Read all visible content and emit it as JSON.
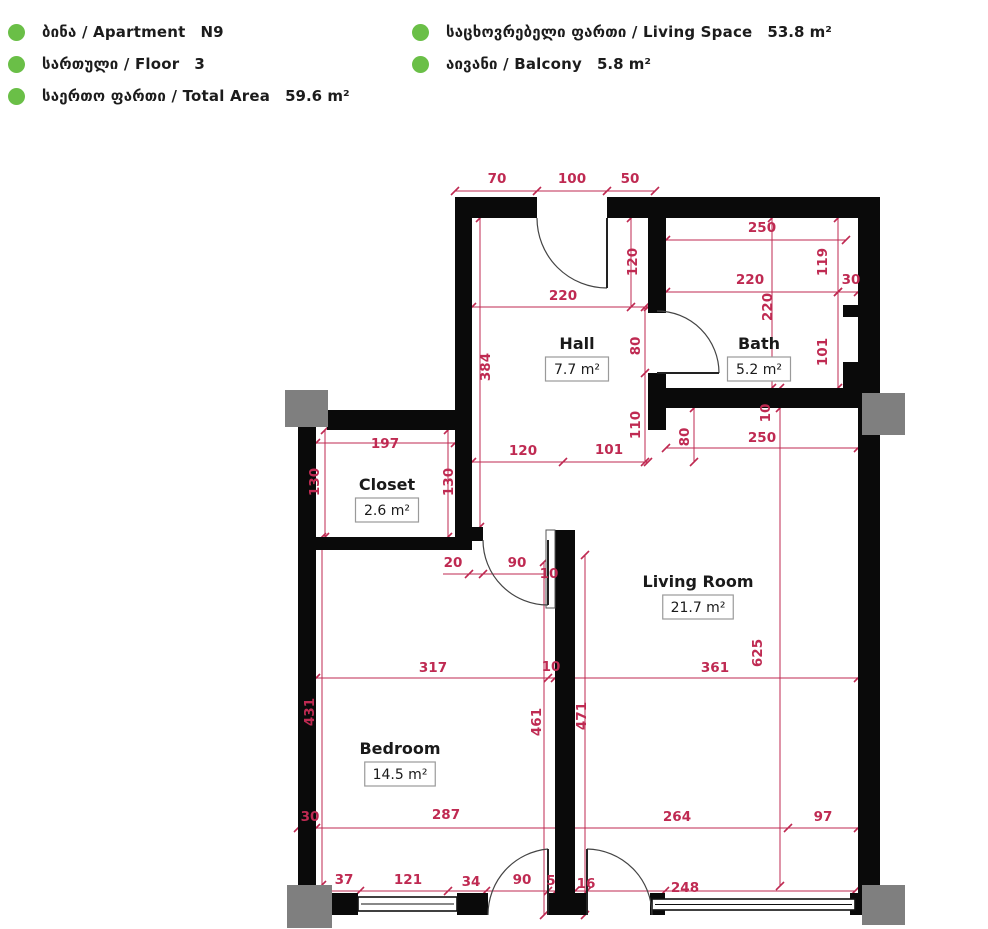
{
  "header": {
    "left": [
      {
        "label": "ბინა / Apartment",
        "value": "N9"
      },
      {
        "label": "სართული / Floor",
        "value": "3"
      },
      {
        "label": "საერთო ფართი / Total Area",
        "value": "59.6 m²"
      }
    ],
    "right": [
      {
        "label": "საცხოვრებელი ფართი / Living Space",
        "value": "53.8 m²"
      },
      {
        "label": "აივანი / Balcony",
        "value": "5.8 m²"
      }
    ]
  },
  "colors": {
    "accent_green": "#6abf47",
    "dim_red": "#bf2a52",
    "wall_black": "#0a0a0a",
    "column_gray": "#7f7f7f",
    "box_border": "#9a9a9a"
  },
  "plan": {
    "rooms": [
      {
        "name": "Hall",
        "area": "7.7 m²",
        "x": 577,
        "y": 349
      },
      {
        "name": "Bath",
        "area": "5.2 m²",
        "x": 759,
        "y": 349
      },
      {
        "name": "Closet",
        "area": "2.6 m²",
        "x": 387,
        "y": 490
      },
      {
        "name": "Living Room",
        "area": "21.7 m²",
        "x": 698,
        "y": 587
      },
      {
        "name": "Bedroom",
        "area": "14.5 m²",
        "x": 400,
        "y": 754
      }
    ],
    "dims": [
      {
        "v": "70",
        "x": 497,
        "y": 183,
        "r": 0
      },
      {
        "v": "100",
        "x": 572,
        "y": 183,
        "r": 0
      },
      {
        "v": "50",
        "x": 630,
        "y": 183,
        "r": 0
      },
      {
        "v": "250",
        "x": 762,
        "y": 232,
        "r": 0
      },
      {
        "v": "119",
        "x": 827,
        "y": 262,
        "r": 1
      },
      {
        "v": "220",
        "x": 750,
        "y": 284,
        "r": 0
      },
      {
        "v": "30",
        "x": 851,
        "y": 284,
        "r": 0
      },
      {
        "v": "220",
        "x": 772,
        "y": 307,
        "r": 1
      },
      {
        "v": "101",
        "x": 827,
        "y": 352,
        "r": 1
      },
      {
        "v": "120",
        "x": 637,
        "y": 262,
        "r": 1
      },
      {
        "v": "220",
        "x": 563,
        "y": 300,
        "r": 0
      },
      {
        "v": "384",
        "x": 490,
        "y": 367,
        "r": 1
      },
      {
        "v": "80",
        "x": 640,
        "y": 346,
        "r": 1
      },
      {
        "v": "110",
        "x": 640,
        "y": 425,
        "r": 1
      },
      {
        "v": "80",
        "x": 689,
        "y": 437,
        "r": 1
      },
      {
        "v": "250",
        "x": 762,
        "y": 442,
        "r": 0
      },
      {
        "v": "10",
        "x": 770,
        "y": 413,
        "r": 1
      },
      {
        "v": "197",
        "x": 385,
        "y": 448,
        "r": 0
      },
      {
        "v": "130",
        "x": 319,
        "y": 482,
        "r": 1
      },
      {
        "v": "130",
        "x": 453,
        "y": 482,
        "r": 1
      },
      {
        "v": "120",
        "x": 523,
        "y": 455,
        "r": 0
      },
      {
        "v": "101",
        "x": 609,
        "y": 454,
        "r": 0
      },
      {
        "v": "20",
        "x": 453,
        "y": 567,
        "r": 0
      },
      {
        "v": "90",
        "x": 517,
        "y": 567,
        "r": 0
      },
      {
        "v": "10",
        "x": 549,
        "y": 578,
        "r": 0
      },
      {
        "v": "317",
        "x": 433,
        "y": 672,
        "r": 0
      },
      {
        "v": "10",
        "x": 551,
        "y": 671,
        "r": 0
      },
      {
        "v": "361",
        "x": 715,
        "y": 672,
        "r": 0
      },
      {
        "v": "625",
        "x": 762,
        "y": 653,
        "r": 1
      },
      {
        "v": "431",
        "x": 314,
        "y": 712,
        "r": 1
      },
      {
        "v": "461",
        "x": 541,
        "y": 722,
        "r": 1
      },
      {
        "v": "471",
        "x": 586,
        "y": 716,
        "r": 1
      },
      {
        "v": "30",
        "x": 310,
        "y": 821,
        "r": 0
      },
      {
        "v": "287",
        "x": 446,
        "y": 819,
        "r": 0
      },
      {
        "v": "264",
        "x": 677,
        "y": 821,
        "r": 0
      },
      {
        "v": "97",
        "x": 823,
        "y": 821,
        "r": 0
      },
      {
        "v": "37",
        "x": 344,
        "y": 884,
        "r": 0
      },
      {
        "v": "121",
        "x": 408,
        "y": 884,
        "r": 0
      },
      {
        "v": "34",
        "x": 471,
        "y": 886,
        "r": 0
      },
      {
        "v": "90",
        "x": 522,
        "y": 884,
        "r": 0
      },
      {
        "v": "5",
        "x": 551,
        "y": 885,
        "r": 0
      },
      {
        "v": "16",
        "x": 586,
        "y": 888,
        "r": 0
      },
      {
        "v": "248",
        "x": 685,
        "y": 892,
        "r": 0
      }
    ],
    "walls": [
      [
        455,
        197,
        82,
        21
      ],
      [
        607,
        197,
        273,
        21
      ],
      [
        858,
        197,
        22,
        718
      ],
      [
        455,
        218,
        17,
        322
      ],
      [
        327,
        410,
        145,
        20
      ],
      [
        298,
        425,
        18,
        468
      ],
      [
        648,
        218,
        18,
        95
      ],
      [
        648,
        373,
        18,
        57
      ],
      [
        658,
        388,
        222,
        20
      ],
      [
        555,
        530,
        20,
        385
      ],
      [
        455,
        527,
        28,
        14
      ],
      [
        316,
        537,
        156,
        13
      ],
      [
        843,
        362,
        15,
        46
      ],
      [
        843,
        305,
        37,
        12
      ],
      [
        316,
        893,
        42,
        22
      ],
      [
        457,
        893,
        31,
        22
      ],
      [
        548,
        893,
        39,
        22
      ],
      [
        650,
        893,
        15,
        22
      ],
      [
        850,
        893,
        30,
        22
      ]
    ],
    "columns": [
      [
        285,
        390,
        43,
        37
      ],
      [
        862,
        393,
        43,
        42
      ],
      [
        287,
        885,
        45,
        43
      ],
      [
        862,
        885,
        43,
        40
      ]
    ],
    "windows": [
      [
        358,
        897,
        99,
        14
      ],
      [
        652,
        899,
        203,
        11
      ]
    ],
    "pocket": [
      546,
      530,
      9,
      78
    ],
    "doors": [
      {
        "leaf": "M607,218 L607,288",
        "arc": "M537,218 A70,70 0 0 0 607,288"
      },
      {
        "leaf": "M657,373 L719,373",
        "arc": "M719,373 A62,62 0 0 0 657,311"
      },
      {
        "leaf": "M548,540 L548,605",
        "arc": "M483,540 A65,65 0 0 0 548,605"
      },
      {
        "leaf": "M548,915 L548,849",
        "arc": "M488,915 A66,66 0 0 1 548,849"
      },
      {
        "leaf": "M587,849 L587,915",
        "arc": "M587,849 A66,66 0 0 1 652,915"
      }
    ],
    "dim_lines": [
      {
        "o": "h",
        "pos": 191,
        "from": 455,
        "to": 655,
        "ticks": [
          455,
          537,
          607,
          655
        ]
      },
      {
        "o": "h",
        "pos": 240,
        "from": 666,
        "to": 846,
        "ticks": [
          666,
          846
        ]
      },
      {
        "o": "h",
        "pos": 292,
        "from": 666,
        "to": 858,
        "ticks": [
          666,
          838,
          858
        ]
      },
      {
        "o": "h",
        "pos": 307,
        "from": 472,
        "to": 648,
        "ticks": [
          472,
          648
        ]
      },
      {
        "o": "h",
        "pos": 448,
        "from": 666,
        "to": 858,
        "ticks": [
          666,
          858
        ]
      },
      {
        "o": "h",
        "pos": 443,
        "from": 316,
        "to": 455,
        "ticks": [
          316,
          455
        ]
      },
      {
        "o": "h",
        "pos": 462,
        "from": 472,
        "to": 648,
        "ticks": [
          472,
          563,
          648
        ]
      },
      {
        "o": "h",
        "pos": 574,
        "from": 443,
        "to": 575,
        "ticks": [
          469,
          483,
          548,
          555
        ]
      },
      {
        "o": "h",
        "pos": 678,
        "from": 316,
        "to": 858,
        "ticks": [
          316,
          548,
          555,
          858
        ]
      },
      {
        "o": "h",
        "pos": 828,
        "from": 298,
        "to": 858,
        "ticks": [
          298,
          316,
          560,
          788,
          858
        ]
      },
      {
        "o": "h",
        "pos": 891,
        "from": 316,
        "to": 855,
        "ticks": [
          316,
          360,
          448,
          486,
          548,
          556,
          575,
          587,
          665,
          855
        ]
      },
      {
        "o": "v",
        "pos": 838,
        "from": 218,
        "to": 388,
        "ticks": [
          218,
          292,
          388
        ]
      },
      {
        "o": "v",
        "pos": 631,
        "from": 218,
        "to": 307,
        "ticks": [
          218,
          307
        ]
      },
      {
        "o": "v",
        "pos": 480,
        "from": 218,
        "to": 527,
        "ticks": [
          218,
          527
        ]
      },
      {
        "o": "v",
        "pos": 645,
        "from": 307,
        "to": 462,
        "ticks": [
          307,
          373,
          462
        ]
      },
      {
        "o": "v",
        "pos": 694,
        "from": 408,
        "to": 462,
        "ticks": [
          408,
          462
        ]
      },
      {
        "o": "v",
        "pos": 772,
        "from": 218,
        "to": 388,
        "ticks": [
          218,
          388
        ]
      },
      {
        "o": "v",
        "pos": 780,
        "from": 388,
        "to": 886,
        "ticks": [
          388,
          408,
          886
        ]
      },
      {
        "o": "v",
        "pos": 325,
        "from": 430,
        "to": 537,
        "ticks": [
          430,
          537
        ]
      },
      {
        "o": "v",
        "pos": 448,
        "from": 430,
        "to": 537,
        "ticks": [
          430,
          537
        ]
      },
      {
        "o": "v",
        "pos": 322,
        "from": 537,
        "to": 885,
        "ticks": [
          537,
          885
        ]
      },
      {
        "o": "v",
        "pos": 544,
        "from": 562,
        "to": 915,
        "ticks": [
          562,
          915
        ]
      },
      {
        "o": "v",
        "pos": 585,
        "from": 555,
        "to": 915,
        "ticks": [
          555,
          915
        ]
      }
    ]
  }
}
